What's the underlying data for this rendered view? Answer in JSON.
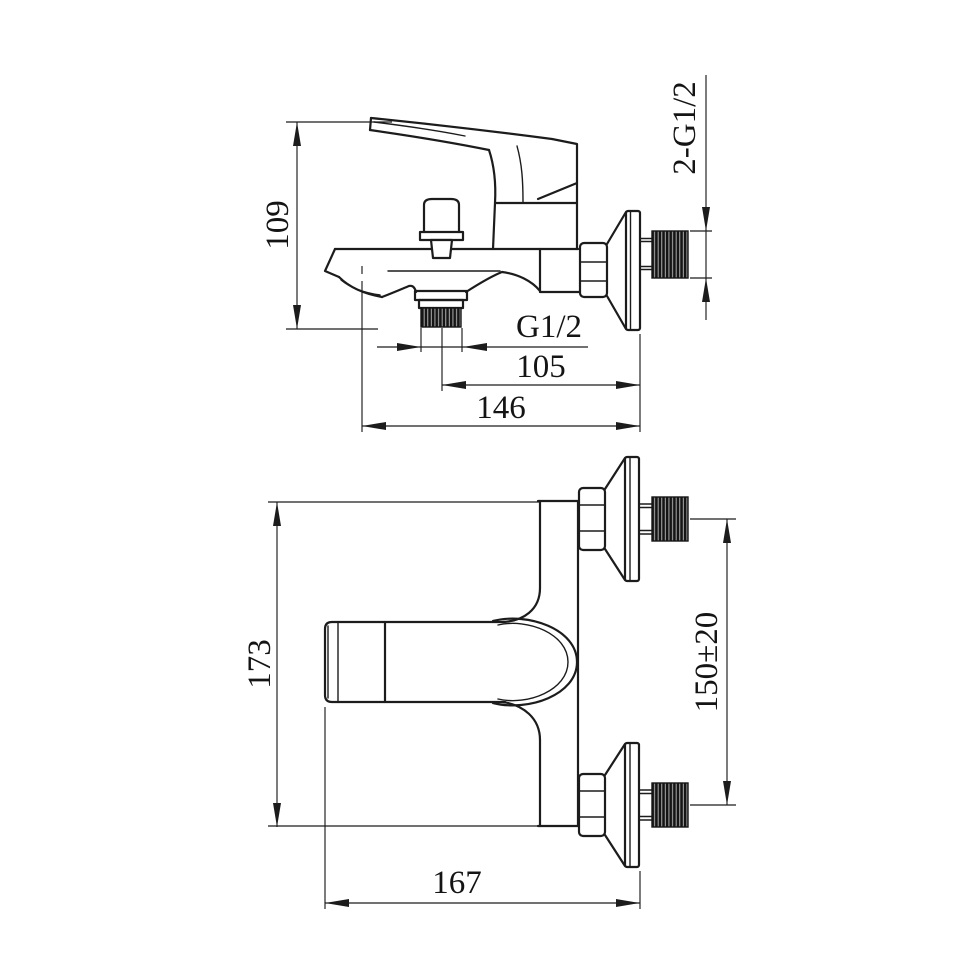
{
  "colors": {
    "line": "#1c1c1c",
    "thread_fill": "#151515",
    "background": "#ffffff"
  },
  "side_view": {
    "label_height": "109",
    "label_outlet_thread": "G1/2",
    "label_reach_center": "105",
    "label_reach_total": "146",
    "label_inlet_thread": "2-G1/2"
  },
  "front_view": {
    "label_body_height": "173",
    "label_inlet_spacing": "150±20",
    "label_width": "167"
  }
}
